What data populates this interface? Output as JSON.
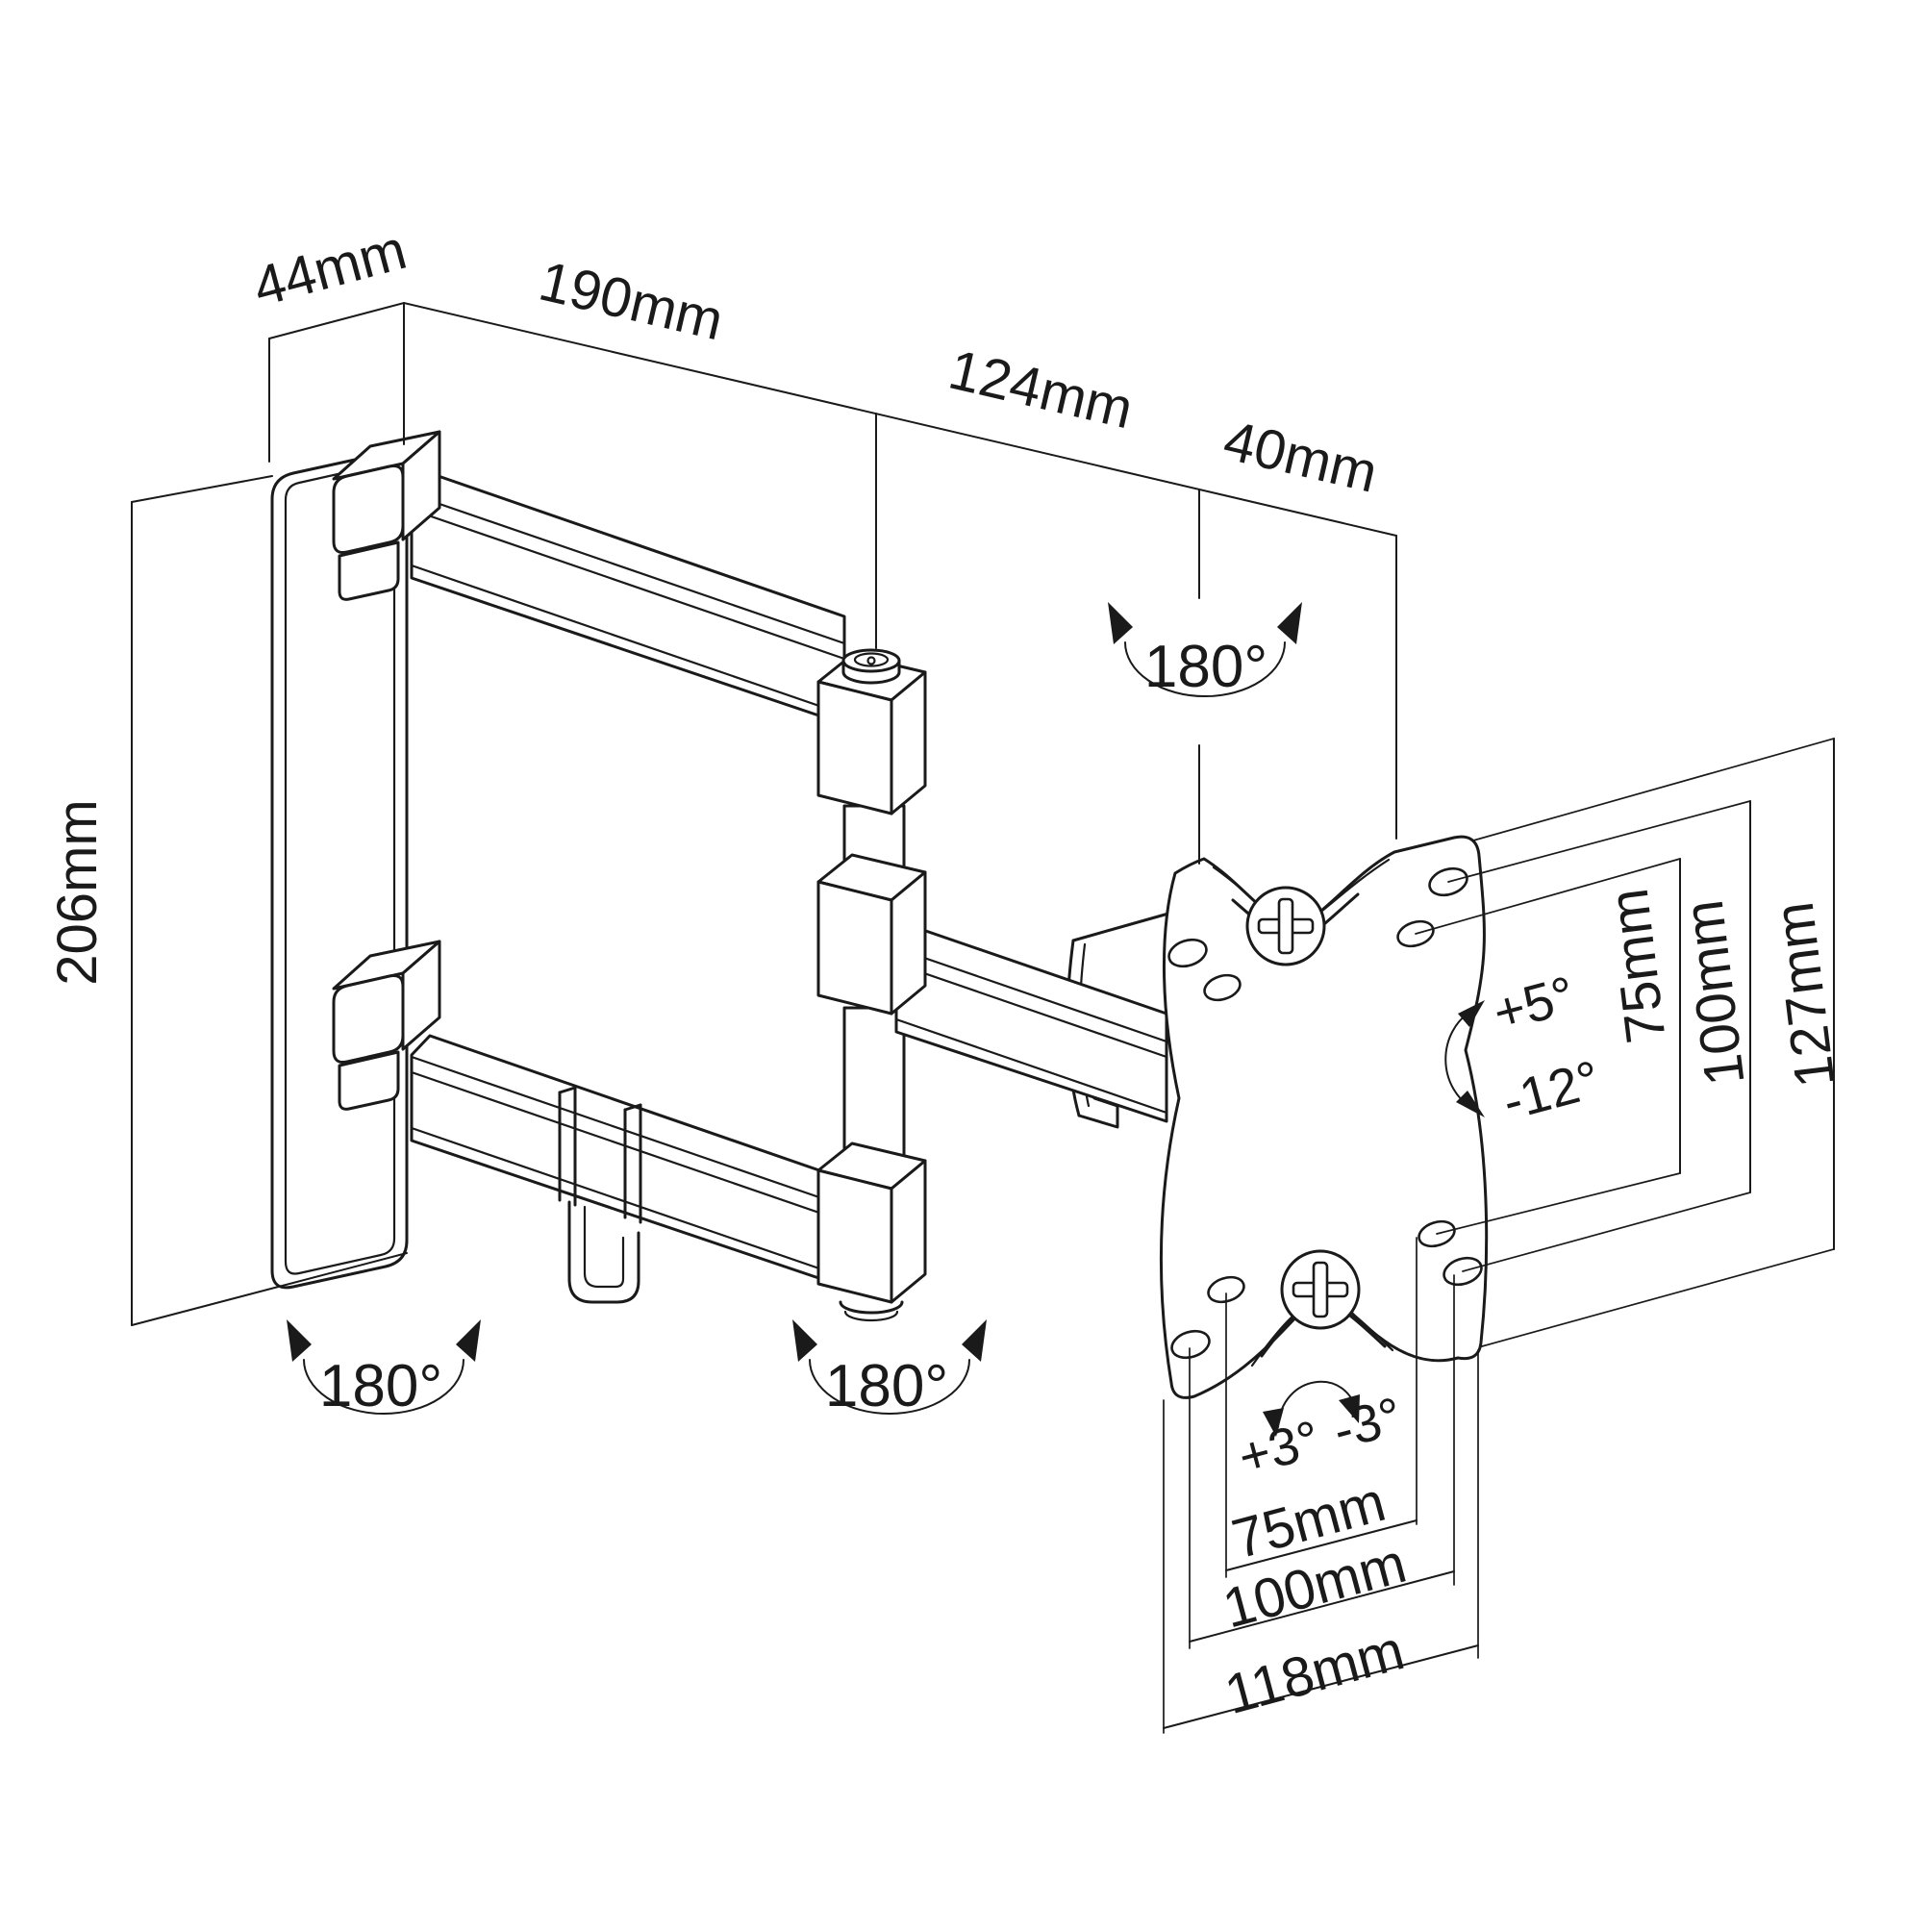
{
  "drawing": {
    "subject": "full-motion TV wall-mount bracket technical drawing, isometric view",
    "line_color": "#1a1a1a",
    "background_color": "#ffffff"
  },
  "dimensions": {
    "wall_plate_depth": "44mm",
    "upper_arm_length": "190mm",
    "forearm_length": "124mm",
    "plate_offset": "40mm",
    "wall_plate_height": "206mm",
    "vesa_vertical_inner": "75mm",
    "vesa_vertical_outer": "100mm",
    "plate_height": "127mm",
    "vesa_horizontal_inner": "75mm",
    "vesa_horizontal_outer": "100mm",
    "plate_width": "118mm"
  },
  "angles": {
    "swivel_plate": "180°",
    "swivel_wall_joint": "180°",
    "swivel_mid_joint": "180°",
    "tilt_up": "+5°",
    "tilt_down": "-12°",
    "roll_left": "+3°",
    "roll_right": "-3°"
  }
}
